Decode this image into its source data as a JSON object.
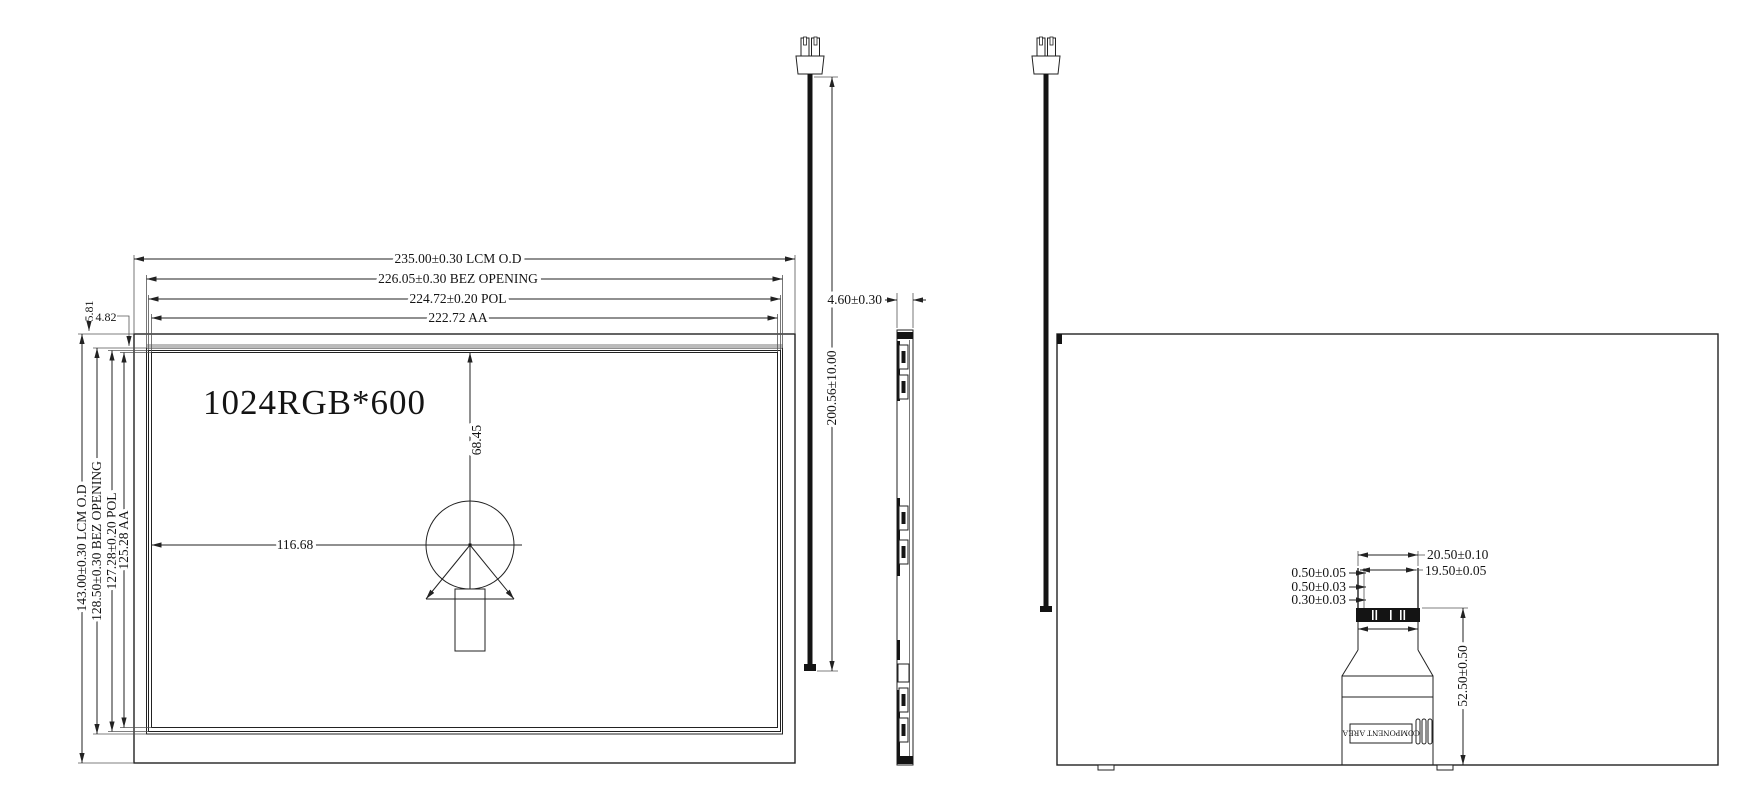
{
  "drawing": {
    "front": {
      "screen_label": "1024RGB*600",
      "dim_width_lcm": "235.00±0.30 LCM O.D",
      "dim_width_bez": "226.05±0.30 BEZ OPENING",
      "dim_width_pol": "224.72±0.20 POL",
      "dim_width_aa": "222.72 AA",
      "dim_height_lcm": "143.00±0.30 LCM O.D",
      "dim_height_bez": "128.50±0.30 BEZ OPENING",
      "dim_height_pol": "127.28±0.20 POL",
      "dim_height_aa": "125.28 AA",
      "dim_top_offset_aa": "5.81",
      "dim_top_offset_bez": "4.82",
      "dim_center_from_top": "68.45",
      "dim_center_from_left": "116.68"
    },
    "side": {
      "dim_thickness": "4.60±0.30",
      "dim_cable_length": "200.56±10.00"
    },
    "back": {
      "dim_fpc_outer_width": "20.50±0.10",
      "dim_fpc_inner_width": "19.50±0.05",
      "dim_layer_1": "0.50±0.05",
      "dim_layer_2": "0.50±0.03",
      "dim_layer_3": "0.30±0.03",
      "dim_fpc_length": "52.50±0.50",
      "component_area_label": "COMPONENT AREA"
    }
  }
}
